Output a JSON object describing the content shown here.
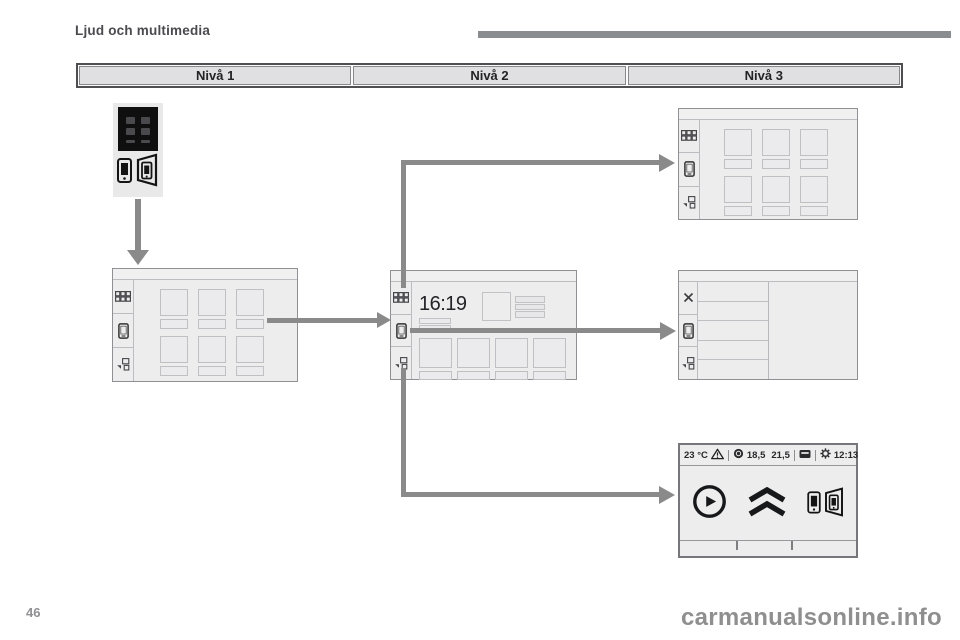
{
  "page": {
    "title": "Ljud och multimedia",
    "page_number": "46",
    "watermark": "carmanualsonline.info"
  },
  "header_table": {
    "columns": [
      {
        "label": "Nivå 1"
      },
      {
        "label": "Nivå 2"
      },
      {
        "label": "Nivå 3"
      }
    ]
  },
  "diagram": {
    "level2_screen": {
      "clock": "16:19"
    },
    "level3_bottom_screen": {
      "status_bar": {
        "outside_temp": "23 °C",
        "value_left": "18,5",
        "value_right": "21,5",
        "time": "12:13"
      }
    },
    "icons": {
      "start_button": "mirror-screen-app-icon",
      "screen_sidebar": [
        "app-grid-icon",
        "smartphone-icon",
        "widget-icon"
      ],
      "level3_middle_sidebar": [
        "close-icon",
        "smartphone-icon",
        "widget-icon"
      ],
      "level3_bottom_logos": [
        "carplay-icon",
        "citroen-logo-icon",
        "mirror-screen-icon"
      ],
      "status_bar_icons": [
        "warning-icon",
        "media-icon",
        "display-icon",
        "gear-icon"
      ]
    },
    "colors": {
      "arrow": "#8a8a8a",
      "screen_fill": "#ededee",
      "screen_border": "#909094",
      "header_fill": "#e0e0e3",
      "icon_dark": "#17181a",
      "watermark": "#8f8f8f"
    }
  }
}
